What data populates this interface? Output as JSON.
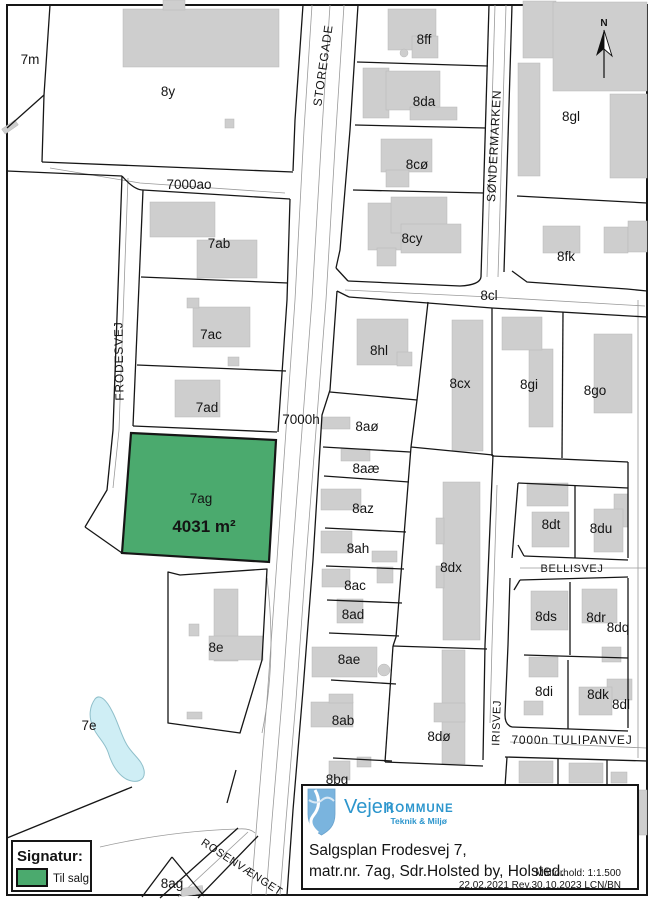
{
  "title": "Salgsplan Frodesvej 7",
  "parcels": {
    "p7m": "7m",
    "p8y": "8y",
    "p8ff": "8ff",
    "p8da": "8da",
    "p8gl": "8gl",
    "p8co": "8cø",
    "p8cy": "8cy",
    "p8fk": "8fk",
    "p8hl": "8hl",
    "p8cx": "8cx",
    "p8gi": "8gi",
    "p8go": "8go",
    "p7ab": "7ab",
    "p7ac": "7ac",
    "p7ad": "7ad",
    "p8ao": "8aø",
    "p8aae": "8aæ",
    "p8az": "8az",
    "p8ah": "8ah",
    "p8ac": "8ac",
    "p8ad": "8ad",
    "p8ae": "8ae",
    "p8ab": "8ab",
    "p8bg": "8bg",
    "p8dx": "8dx",
    "p8do": "8dø",
    "p8dt": "8dt",
    "p8du": "8du",
    "p8ds": "8ds",
    "p8dr": "8dr",
    "p8dq": "8dq",
    "p8di": "8di",
    "p8dk": "8dk",
    "p8dl": "8dl",
    "p8e": "8e",
    "p7e": "7e",
    "p8ag": "8ag",
    "pf": "f"
  },
  "sale_parcel": {
    "label": "7ag",
    "area": "4031 m²",
    "color": "#4baa6e"
  },
  "streets": {
    "storegade": "STOREGADE",
    "soendermarken": "SØNDERMARKEN",
    "frodesvej": "FRODESVEJ",
    "bellisvej": "BELLISVEJ",
    "irisvej": "IRISVEJ",
    "tulipanvej_7000n": "7000n TULIPANVEJ",
    "rosenvaenget": "ROSENVÆNGET",
    "road_7000ao": "7000ao",
    "road_7000h": "7000h",
    "road_8cl": "8cl"
  },
  "compass": {
    "north": "N"
  },
  "legend": {
    "title": "Signatur:",
    "til_salg": "Til salg"
  },
  "infobox": {
    "org": "Vejen",
    "org2": "KOMMUNE",
    "dept": "Teknik & Miljø",
    "line1": "Salgsplan Frodesvej 7,",
    "line2": "matr.nr. 7ag, Sdr.Holsted by, Holsted.",
    "scale": "Målforhold: 1:1.500",
    "revision": "22.02.2021 Rev.30.10.2023 LCN/BN"
  },
  "colors": {
    "sale_green": "#4baa6e",
    "pond_blue": "#cfeef5",
    "building_gray": "#cecece",
    "brand_blue": "#2d96cd"
  }
}
